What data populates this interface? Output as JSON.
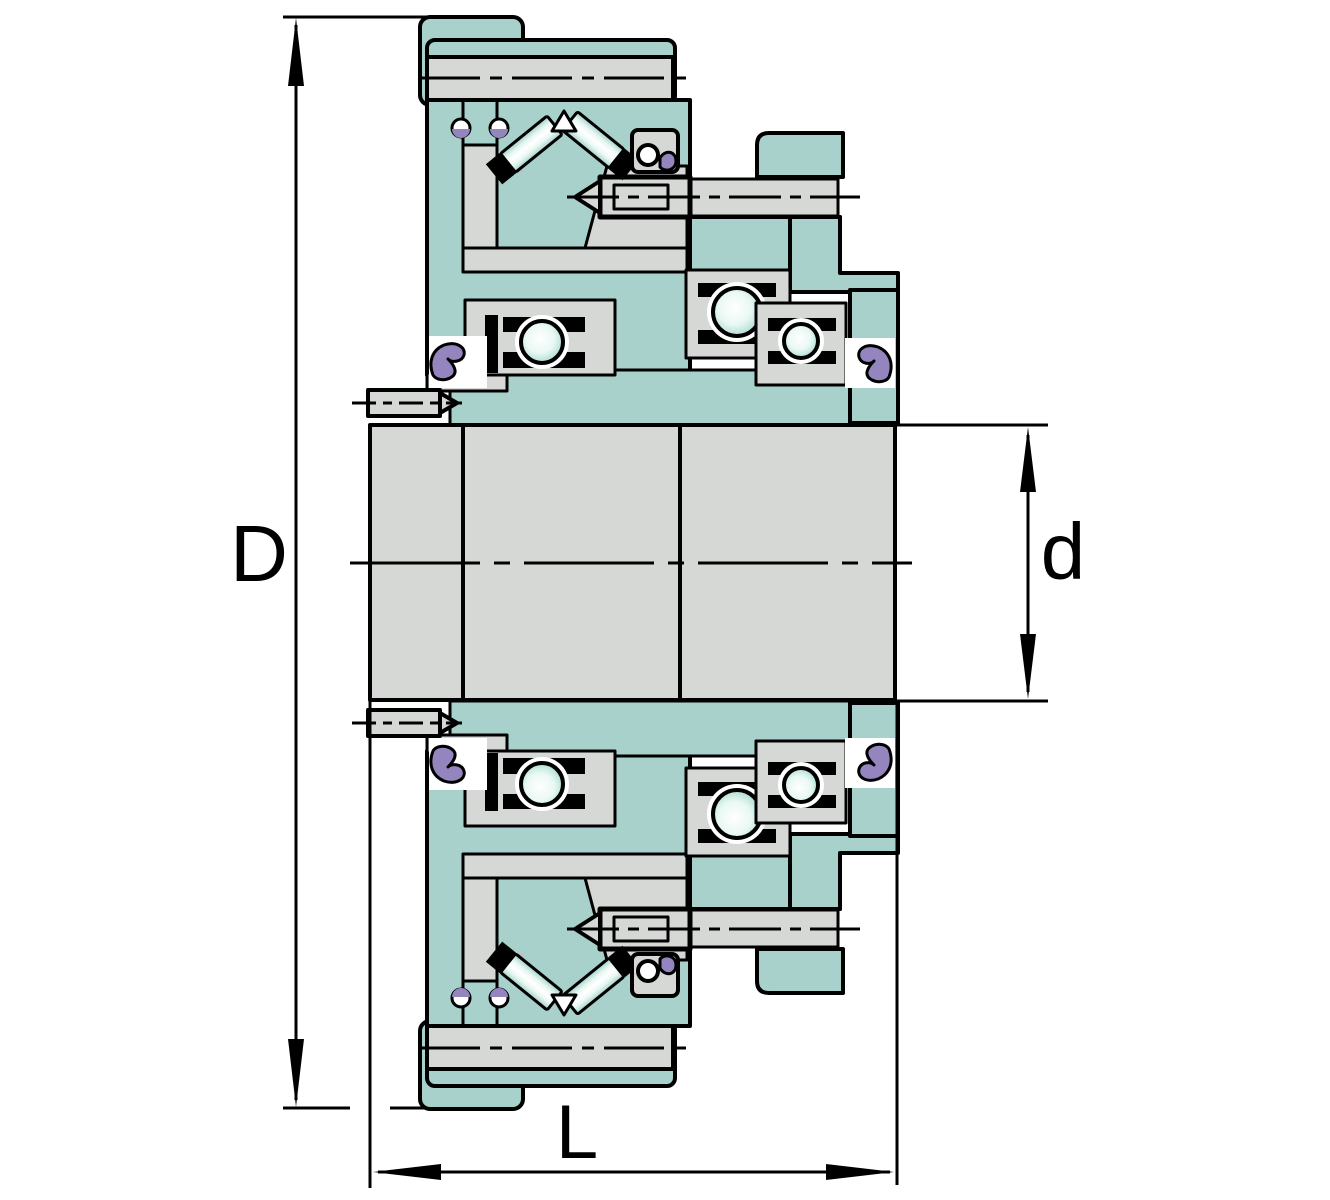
{
  "drawing": {
    "type": "technical-cross-section",
    "description": "Bearing clutch unit cross-section with dimension arrows",
    "dimension_labels": {
      "outer_diameter": "D",
      "bore_diameter": "d",
      "length": "L"
    }
  },
  "colors": {
    "housing": "#a7d1ca",
    "metal": "#d6d8d6",
    "seal": "#9585bf",
    "cage": "#cdb9c4",
    "outline": "#000000",
    "paper": "#ffffff",
    "ball-center": "#ffffff",
    "ball-edge": "#a3d9cf"
  }
}
